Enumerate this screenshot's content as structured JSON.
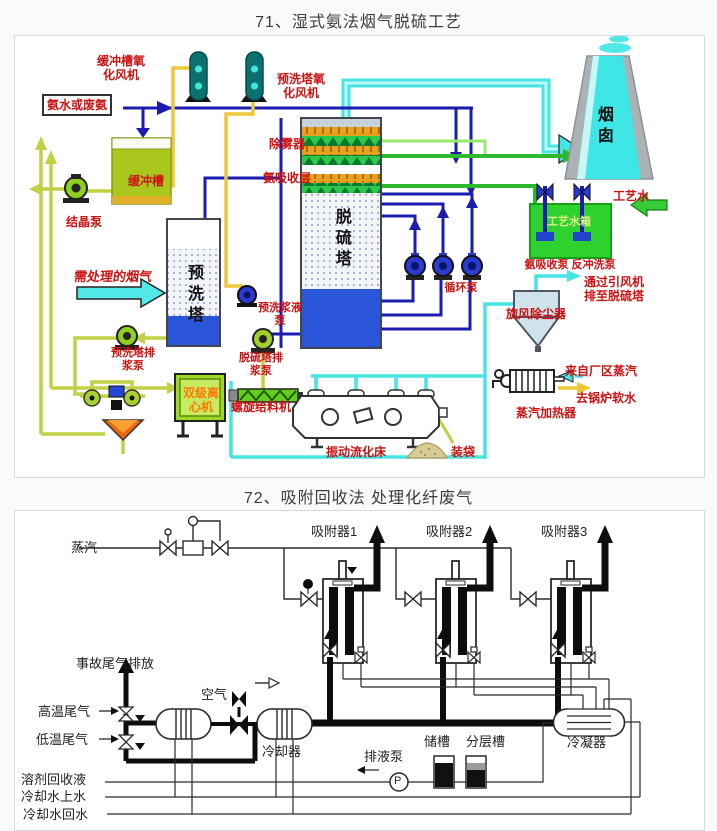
{
  "page": {
    "width": 717,
    "height": 831,
    "background": "#fafafa",
    "panel_background": "#ffffff",
    "panel_border": "#d9d9d9"
  },
  "diagram1": {
    "title": "71、湿式氨法烟气脱硫工艺",
    "label_color": "#cc1111",
    "labels": {
      "ammonia_feed": "氨水或废氨",
      "buffer_fan": "缓冲槽氧化风机",
      "prewash_fan": "预洗塔氧化风机",
      "demister": "除雾器",
      "absorb_layer": "氨吸收层",
      "buffer_tank": "缓冲槽",
      "crystal_pump": "结晶泵",
      "flue_gas_in": "需处理的烟气",
      "prewash_tower": "预洗塔",
      "desulf_tower": "脱硫塔",
      "prewash_slurry_pump": "预洗浆液泵",
      "circulation_pump": "循环泵",
      "prewash_discharge_pump": "预洗塔排浆泵",
      "desulf_discharge_pump": "脱硫塔排浆泵",
      "chimney": "烟囱",
      "process_water": "工艺水",
      "process_water_tank": "工艺水箱",
      "tank_pumps": "氨吸收泵 反冲洗泵",
      "to_desulf_tower": "通过引风机排至脱硫塔",
      "cyclone": "旋风除尘器",
      "steam_from_plant": "来自厂区蒸汽",
      "to_boiler_water": "去锅炉软水",
      "steam_heater": "蒸汽加热器",
      "centrifuge": "双级离心机",
      "screw_feeder": "螺旋给料机",
      "fluidized_bed": "振动流化床",
      "bagging": "装袋"
    },
    "colors": {
      "pipe_navy": "#1c1cb0",
      "pipe_yellow": "#ecc83a",
      "pipe_yellow_green": "#c2d044",
      "pipe_green": "#2db82d",
      "pipe_cyan": "#47e4e4",
      "tank_green": "#2ed12e",
      "buffer_tank_fill": "#a9c71d",
      "tower_liquid_blue": "#2b55d8",
      "fan_teal": "#0b7070",
      "centrifuge_fill": "#9fd823",
      "funnel_orange": "#e8680e",
      "chimney_cyan": "#3fe6e6"
    }
  },
  "diagram2": {
    "title": "72、吸附回收法 处理化纤废气",
    "line_color": "#2a2a2a",
    "labels": {
      "steam": "蒸汽",
      "adsorber1": "吸附器1",
      "adsorber2": "吸附器2",
      "adsorber3": "吸附器3",
      "accident_vent": "事故尾气排放",
      "air": "空气",
      "hot_tail_gas": "高温尾气",
      "cold_tail_gas": "低温尾气",
      "solvent_recovery": "溶剂回收液",
      "cooling_water_supply": "冷却水上水",
      "cooling_water_return": "冷却水回水",
      "cooler": "冷却器",
      "drain_pump": "排液泵",
      "pump_symbol": "P",
      "storage_tank": "储槽",
      "layer_tank": "分层槽",
      "condenser": "冷凝器"
    }
  }
}
